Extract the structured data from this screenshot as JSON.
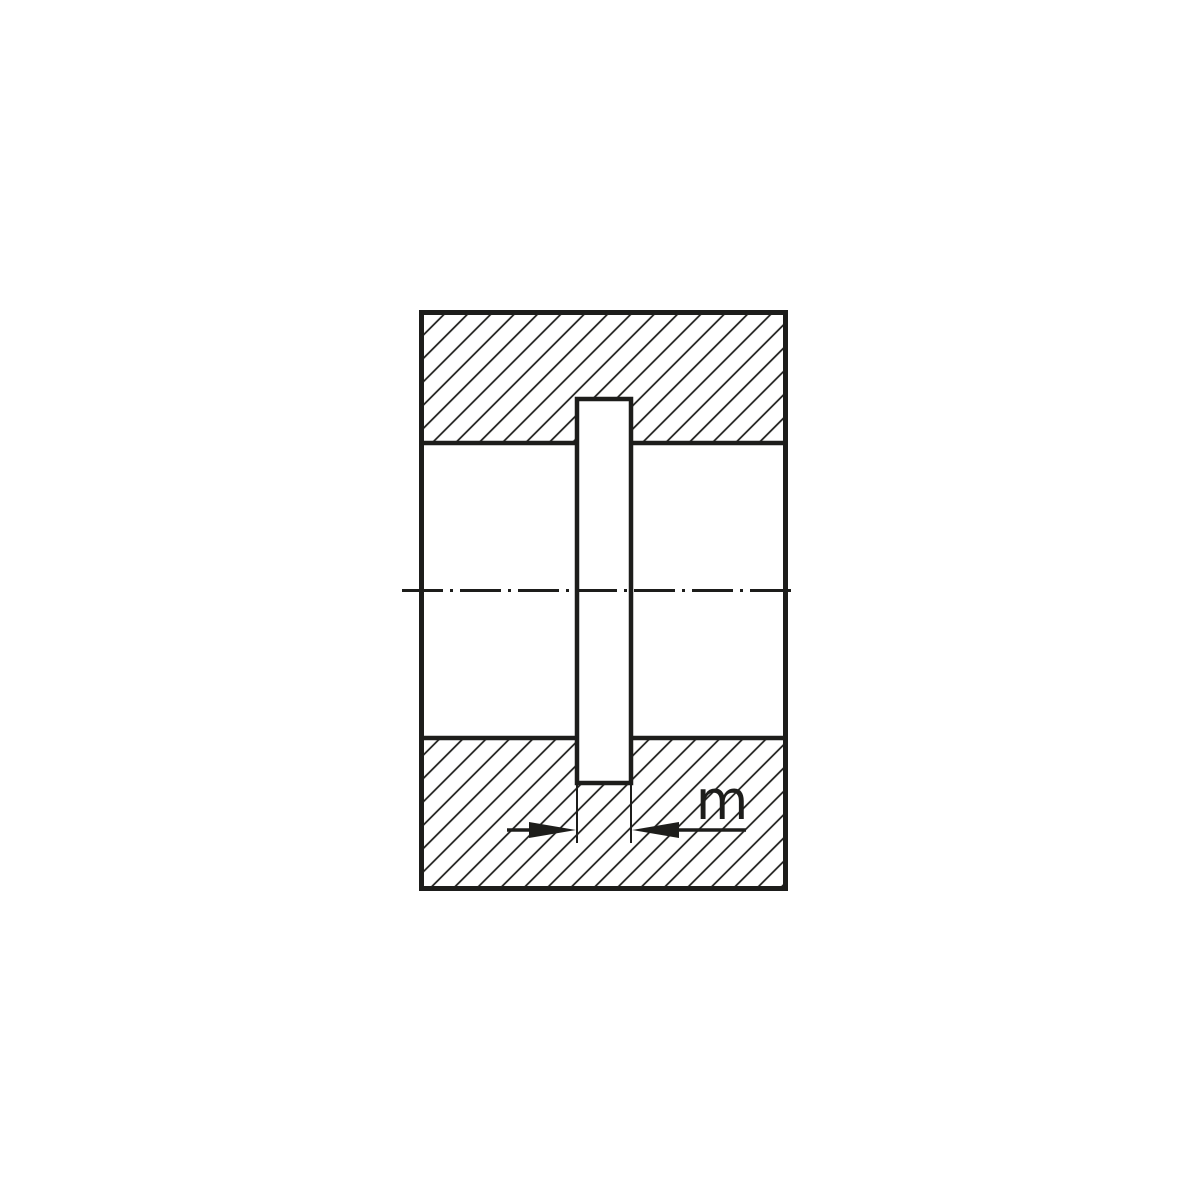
{
  "drawing": {
    "description": "technical-section-view-of-hub-with-keyway",
    "dimension_label": "m",
    "line_color": "#1d1d1b",
    "background_color": "#ffffff"
  }
}
